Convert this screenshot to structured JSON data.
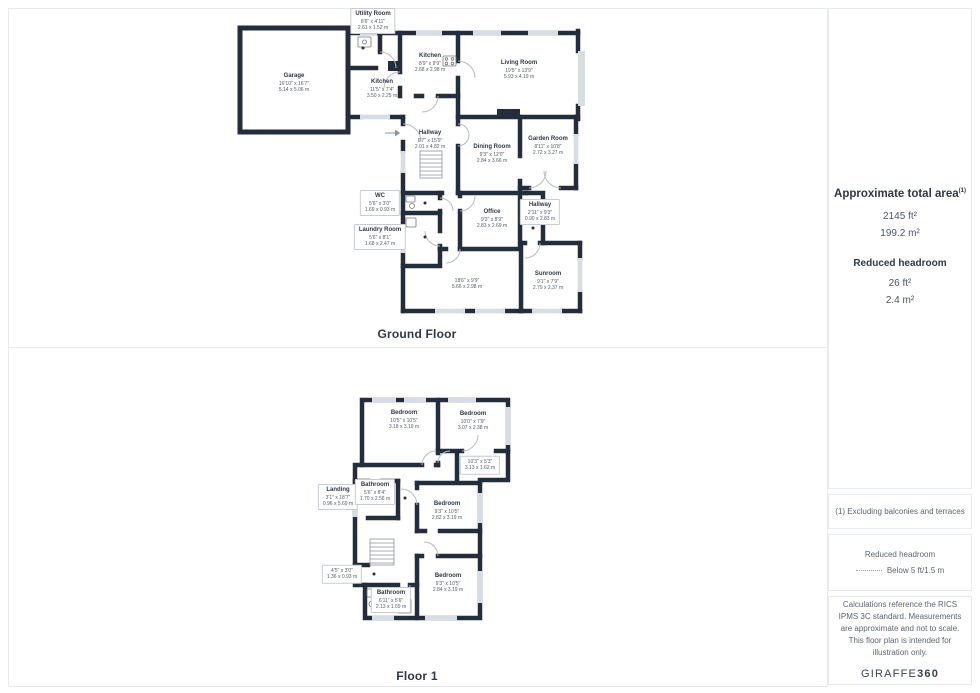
{
  "colors": {
    "wall": "#232d3b",
    "window": "#d8dde4",
    "door_arc": "#b4bbc5",
    "border": "#e7eaee"
  },
  "floors": [
    {
      "title": "Ground Floor",
      "rooms": [
        {
          "name": "Garage",
          "imperial": "16'10\" x 16'7\"",
          "metric": "5.14 x 5.06 m",
          "x": 64,
          "y": 77,
          "boxed": false
        },
        {
          "name": "Utility Room",
          "imperial": "8'6\" x 4'11\"",
          "metric": "2.61 x 1.52 m",
          "x": 143,
          "y": 15,
          "boxed": true
        },
        {
          "name": "Kitchen",
          "imperial": "8'9\" x 9'9\"",
          "metric": "2.68 x 2.98 m",
          "x": 200,
          "y": 57,
          "boxed": false
        },
        {
          "name": "Kitchen",
          "imperial": "11'5\" x 7'4\"",
          "metric": "3.50 x 2.25 m",
          "x": 152,
          "y": 83,
          "boxed": false
        },
        {
          "name": "Living Room",
          "imperial": "19'5\" x 13'9\"",
          "metric": "5.93 x 4.19 m",
          "x": 289,
          "y": 64,
          "boxed": false
        },
        {
          "name": "Hallway",
          "imperial": "6'7\" x 15'9\"",
          "metric": "2.01 x 4.82 m",
          "x": 200,
          "y": 134,
          "boxed": false
        },
        {
          "name": "Dining Room",
          "imperial": "9'3\" x 12'0\"",
          "metric": "2.84 x 3.66 m",
          "x": 262,
          "y": 148,
          "boxed": false
        },
        {
          "name": "Garden Room",
          "imperial": "8'11\" x 10'8\"",
          "metric": "2.72 x 3.27 m",
          "x": 318,
          "y": 140,
          "boxed": false
        },
        {
          "name": "WC",
          "imperial": "5'6\" x 3'0\"",
          "metric": "1.69 x 0.93 m",
          "x": 150,
          "y": 197,
          "boxed": true
        },
        {
          "name": "Hallway",
          "imperial": "2'11\" x 9'3\"",
          "metric": "0.90 x 2.83 m",
          "x": 310,
          "y": 206,
          "boxed": true
        },
        {
          "name": "Office",
          "imperial": "9'3\" x 8'9\"",
          "metric": "2.83 x 2.69 m",
          "x": 262,
          "y": 213,
          "boxed": false
        },
        {
          "name": "Laundry Room",
          "imperial": "5'6\" x 8'1\"",
          "metric": "1.68 x 2.47 m",
          "x": 150,
          "y": 231,
          "boxed": true
        },
        {
          "name": "",
          "imperial": "18'6\" x 9'9\"",
          "metric": "5.66 x 2.98 m",
          "x": 237,
          "y": 278,
          "boxed": false
        },
        {
          "name": "Sunroom",
          "imperial": "9'1\" x 7'9\"",
          "metric": "2.79 x 2.37 m",
          "x": 318,
          "y": 275,
          "boxed": false
        }
      ]
    },
    {
      "title": "Floor 1",
      "rooms": [
        {
          "name": "Bedroom",
          "imperial": "10'5\" x 10'5\"",
          "metric": "3.18 x 3.19 m",
          "x": 94,
          "y": 27,
          "boxed": false
        },
        {
          "name": "Bedroom",
          "imperial": "10'0\" x 7'9\"",
          "metric": "3.07 x 2.38 m",
          "x": 163,
          "y": 28,
          "boxed": false
        },
        {
          "name": "",
          "imperial": "10'3\" x 5'3\"",
          "metric": "3.13 x 1.62 m",
          "x": 170,
          "y": 72,
          "boxed": true
        },
        {
          "name": "Landing",
          "imperial": "3'1\" x 18'7\"",
          "metric": "0.96 x 5.69 m",
          "x": 28,
          "y": 104,
          "boxed": true
        },
        {
          "name": "Bathroom",
          "imperial": "5'6\" x 8'4\"",
          "metric": "1.70 x 2.56 m",
          "x": 65,
          "y": 99,
          "boxed": true
        },
        {
          "name": "Bedroom",
          "imperial": "9'3\" x 10'5\"",
          "metric": "2.82 x 3.19 m",
          "x": 137,
          "y": 118,
          "boxed": false
        },
        {
          "name": "",
          "imperial": "4'5\" x 3'0\"",
          "metric": "1.36 x 0.93 m",
          "x": 32,
          "y": 181,
          "boxed": true
        },
        {
          "name": "Bedroom",
          "imperial": "9'3\" x 10'5\"",
          "metric": "2.84 x 3.19 m",
          "x": 138,
          "y": 190,
          "boxed": false
        },
        {
          "name": "Bathroom",
          "imperial": "6'11\" x 5'6\"",
          "metric": "2.13 x 1.69 m",
          "x": 81,
          "y": 207,
          "boxed": true
        }
      ]
    }
  ],
  "sidebar": {
    "total_area": {
      "title": "Approximate total area",
      "sup": "(1)",
      "ft": "2145 ft²",
      "m": "199.2 m²"
    },
    "reduced_headroom": {
      "title": "Reduced headroom",
      "ft": "26 ft²",
      "m": "2.4 m²"
    },
    "note1": "(1) Excluding balconies and terraces",
    "legend": {
      "title": "Reduced headroom",
      "value": "Below 5 ft/1.5 m"
    },
    "disclaimer": "Calculations reference the RICS IPMS 3C standard. Measurements are approximate and not to scale. This floor plan is intended for illustration only.",
    "brand": {
      "name": "GIRAFFE",
      "suffix": "360"
    }
  }
}
